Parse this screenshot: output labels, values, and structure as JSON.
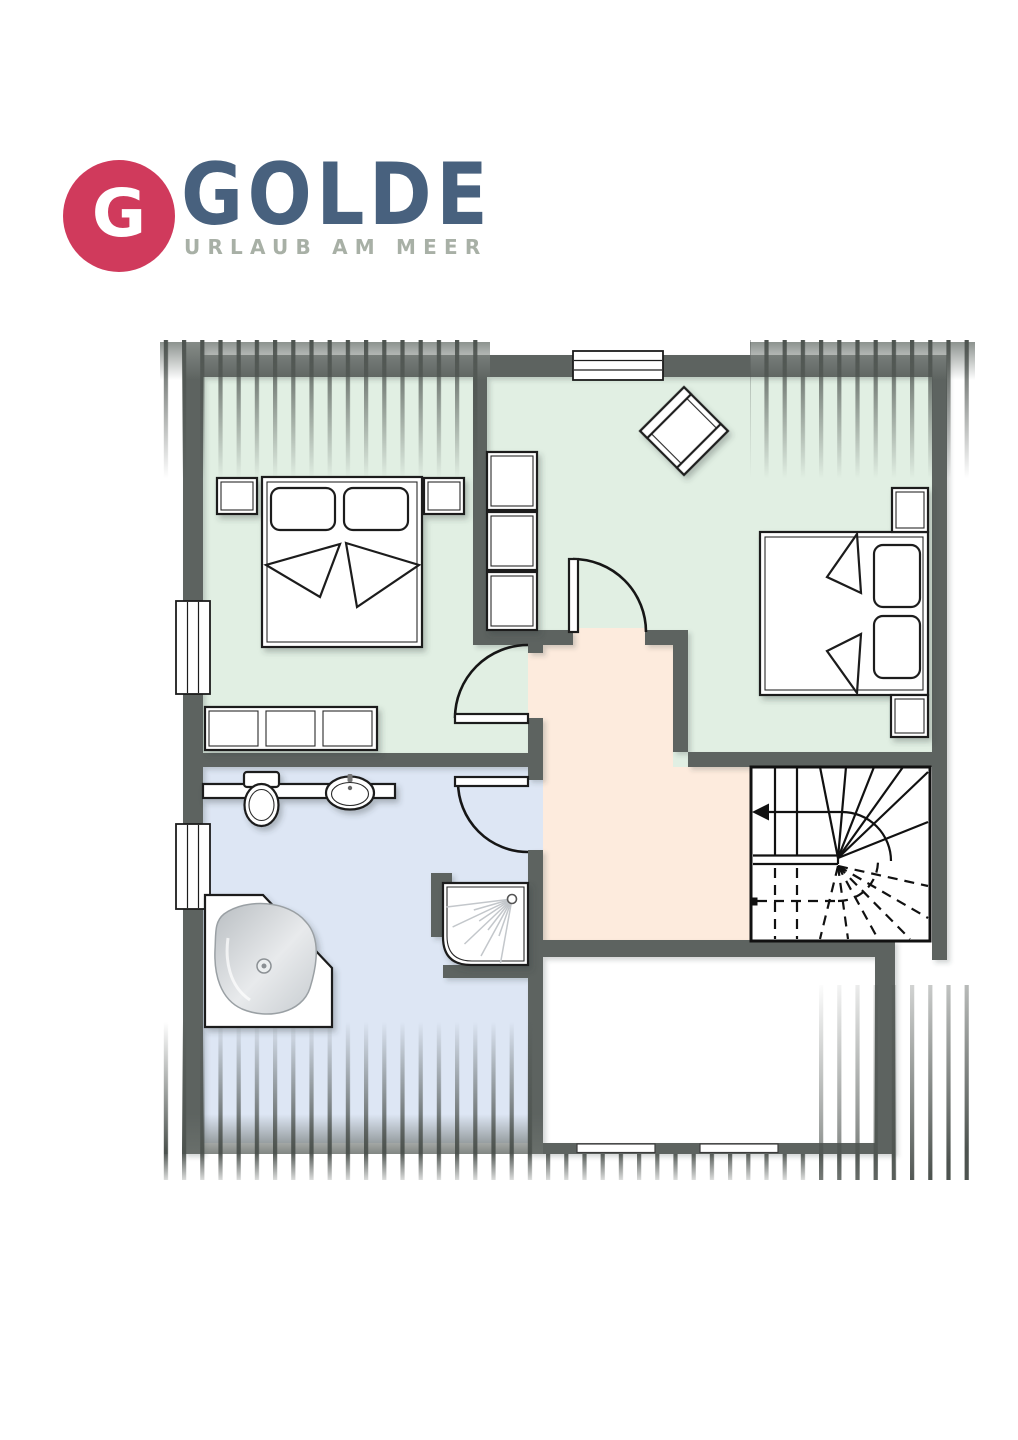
{
  "logo": {
    "monogram": "G",
    "brand": "GOLDE",
    "tagline": "URLAUB AM MEER"
  },
  "colors": {
    "logo_red": "#d03a5c",
    "brand_blue": "#48617e",
    "tagline_gray": "#a8b0a6",
    "wall": "#5d6360",
    "outline": "#1c1c1c",
    "room_bedroom": "#e1efe3",
    "room_bath": "#dde6f4",
    "room_hall": "#fdebdd",
    "room_plain": "#ffffff",
    "stripe": "#4d534f",
    "fixture_gray": "#cfd3d6"
  }
}
